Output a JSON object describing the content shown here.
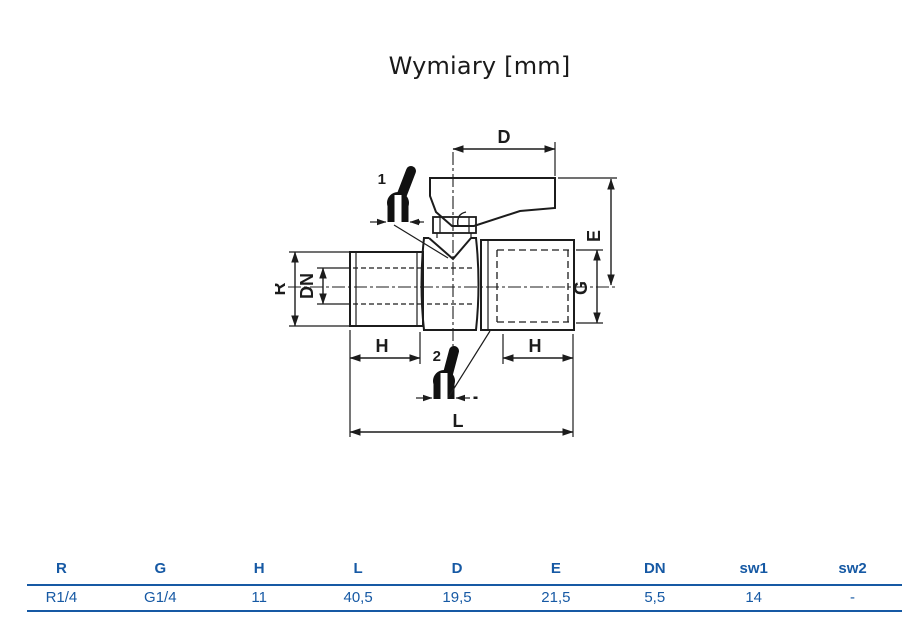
{
  "title": "Wymiary [mm]",
  "drawing": {
    "dimension_labels": {
      "D": "D",
      "E": "E",
      "G": "G",
      "R": "R",
      "DN": "DN",
      "H_left": "H",
      "H_right": "H",
      "L": "L"
    },
    "handle_positions": {
      "pos1": "1",
      "pos2": "2"
    }
  },
  "table": {
    "headers": [
      "R",
      "G",
      "H",
      "L",
      "D",
      "E",
      "DN",
      "sw1",
      "sw2"
    ],
    "rows": [
      [
        "R1/4",
        "G1/4",
        "11",
        "40,5",
        "19,5",
        "21,5",
        "5,5",
        "14",
        "-"
      ]
    ]
  },
  "colors": {
    "table_blue": "#1659a4",
    "drawing_line": "#1c1c1c"
  }
}
